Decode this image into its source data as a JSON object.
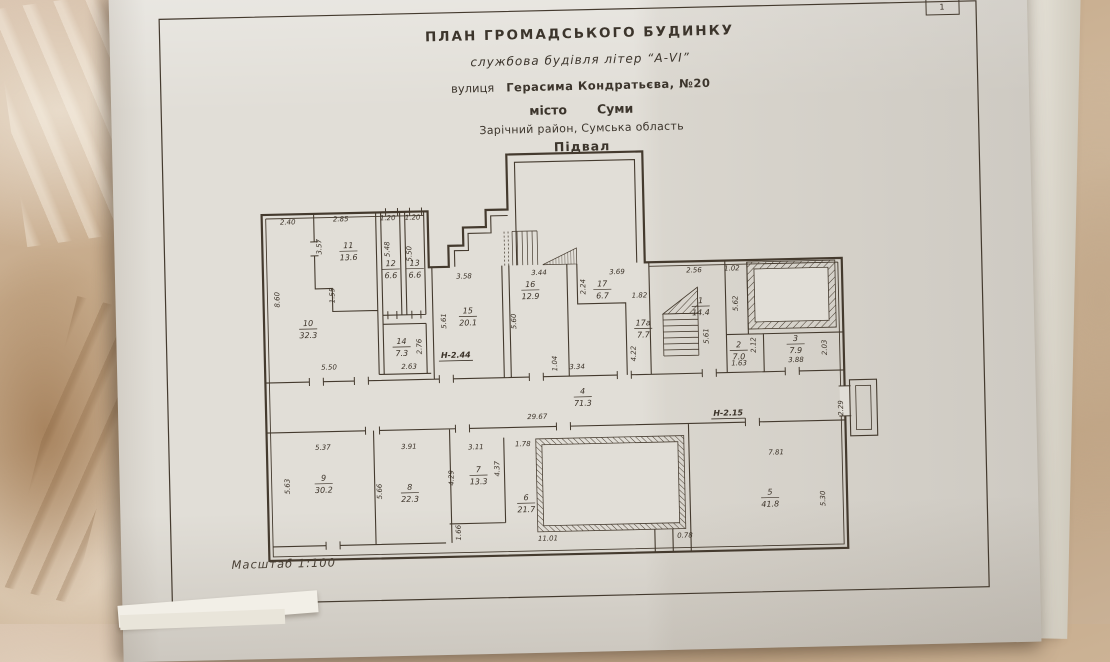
{
  "page": {
    "page_number": "1"
  },
  "title_block": {
    "line1": "ПЛАН  ГРОМАДСЬКОГО  БУДИНКУ",
    "line2": "службова будівля літер “А-VI”",
    "line3_label": "вулиця",
    "line3_value": "Герасима Кондратьєва, №20",
    "line4_label": "місто",
    "line4_value": "Суми",
    "line5": "Зарічний район, Сумська область",
    "line6": "Підвал"
  },
  "scale_label": "Масштаб  1:100",
  "colors": {
    "paper": "#e1ded7",
    "ink": "#443a2e",
    "marble": "#c9b196"
  },
  "plan": {
    "rooms": [
      {
        "n": "10",
        "a": "32.3",
        "x": 192,
        "y": 339
      },
      {
        "n": "11",
        "a": "13.6",
        "x": 234,
        "y": 262
      },
      {
        "n": "12",
        "a": "6.6",
        "x": 276,
        "y": 281
      },
      {
        "n": "13",
        "a": "6.6",
        "x": 300,
        "y": 281
      },
      {
        "n": "14",
        "a": "7.3",
        "x": 285,
        "y": 359
      },
      {
        "n": "15",
        "a": "20.1",
        "x": 352,
        "y": 330
      },
      {
        "n": "16",
        "a": "12.9",
        "x": 415,
        "y": 305
      },
      {
        "n": "17",
        "a": "6.7",
        "x": 487,
        "y": 306
      },
      {
        "n": "17а",
        "a": "7.7",
        "x": 527,
        "y": 346
      },
      {
        "n": "1",
        "a": "14.4",
        "x": 585,
        "y": 325
      },
      {
        "n": "2",
        "a": "7.0",
        "x": 622,
        "y": 370
      },
      {
        "n": "3",
        "a": "7.9",
        "x": 679,
        "y": 365
      },
      {
        "n": "4",
        "a": "71.3",
        "x": 465,
        "y": 413
      },
      {
        "n": "5",
        "a": "41.8",
        "x": 650,
        "y": 518
      },
      {
        "n": "6",
        "a": "21.7",
        "x": 406,
        "y": 518
      },
      {
        "n": "7",
        "a": "13.3",
        "x": 359,
        "y": 489
      },
      {
        "n": "8",
        "a": "22.3",
        "x": 290,
        "y": 505
      },
      {
        "n": "9",
        "a": "30.2",
        "x": 204,
        "y": 494
      }
    ],
    "dims": [
      {
        "t": "2.40",
        "x": 174,
        "y": 234
      },
      {
        "t": "2.85",
        "x": 227,
        "y": 232
      },
      {
        "t": "1.20",
        "x": 274,
        "y": 232
      },
      {
        "t": "1.20",
        "x": 299,
        "y": 232
      },
      {
        "t": "3.57",
        "x": 207,
        "y": 257,
        "r": -90
      },
      {
        "t": "1.55",
        "x": 219,
        "y": 306,
        "r": -90
      },
      {
        "t": "8.60",
        "x": 164,
        "y": 309,
        "r": -90
      },
      {
        "t": "5.48",
        "x": 275,
        "y": 261,
        "r": -90
      },
      {
        "t": "5.50",
        "x": 297,
        "y": 266,
        "r": -90
      },
      {
        "t": "5.50",
        "x": 212,
        "y": 380
      },
      {
        "t": "2.76",
        "x": 305,
        "y": 359,
        "r": -90
      },
      {
        "t": "2.63",
        "x": 292,
        "y": 381
      },
      {
        "t": "3.58",
        "x": 349,
        "y": 292
      },
      {
        "t": "5.61",
        "x": 330,
        "y": 334,
        "r": -90
      },
      {
        "t": "3.44",
        "x": 424,
        "y": 290
      },
      {
        "t": "5.60",
        "x": 400,
        "y": 336,
        "r": -90
      },
      {
        "t": "3.69",
        "x": 502,
        "y": 291
      },
      {
        "t": "2.24",
        "x": 470,
        "y": 303,
        "r": -90
      },
      {
        "t": "1.82",
        "x": 524,
        "y": 315
      },
      {
        "t": "4.22",
        "x": 519,
        "y": 371,
        "r": -90
      },
      {
        "t": "2.56",
        "x": 579,
        "y": 291
      },
      {
        "t": "5.61",
        "x": 592,
        "y": 355,
        "r": -90
      },
      {
        "t": "1.02",
        "x": 617,
        "y": 290
      },
      {
        "t": "5.62",
        "x": 622,
        "y": 323,
        "r": -90
      },
      {
        "t": "2.12",
        "x": 639,
        "y": 365,
        "r": -90
      },
      {
        "t": "1.63",
        "x": 622,
        "y": 385
      },
      {
        "t": "3.88",
        "x": 679,
        "y": 383
      },
      {
        "t": "2.03",
        "x": 710,
        "y": 369,
        "r": -90
      },
      {
        "t": "1.04",
        "x": 440,
        "y": 379,
        "r": -90
      },
      {
        "t": "3.34",
        "x": 460,
        "y": 385
      },
      {
        "t": "29.67",
        "x": 419,
        "y": 434
      },
      {
        "t": "2.29",
        "x": 725,
        "y": 430,
        "r": -90
      },
      {
        "t": "5.37",
        "x": 204,
        "y": 460
      },
      {
        "t": "5.63",
        "x": 170,
        "y": 496,
        "r": -90
      },
      {
        "t": "3.91",
        "x": 290,
        "y": 461
      },
      {
        "t": "5.66",
        "x": 262,
        "y": 503,
        "r": -90
      },
      {
        "t": "3.11",
        "x": 357,
        "y": 463
      },
      {
        "t": "4.29",
        "x": 334,
        "y": 491,
        "r": -90
      },
      {
        "t": "4.37",
        "x": 380,
        "y": 483,
        "r": -90
      },
      {
        "t": "1.78",
        "x": 404,
        "y": 461
      },
      {
        "t": "1.66",
        "x": 340,
        "y": 546,
        "r": -90
      },
      {
        "t": "11.01",
        "x": 427,
        "y": 556
      },
      {
        "t": "0.78",
        "x": 564,
        "y": 556
      },
      {
        "t": "7.81",
        "x": 657,
        "y": 475
      },
      {
        "t": "5.30",
        "x": 705,
        "y": 520,
        "r": -90
      }
    ],
    "notes": [
      {
        "t": "Н-2.44",
        "x": 339,
        "y": 371
      },
      {
        "t": "Н-2.15",
        "x": 610,
        "y": 435
      }
    ]
  }
}
